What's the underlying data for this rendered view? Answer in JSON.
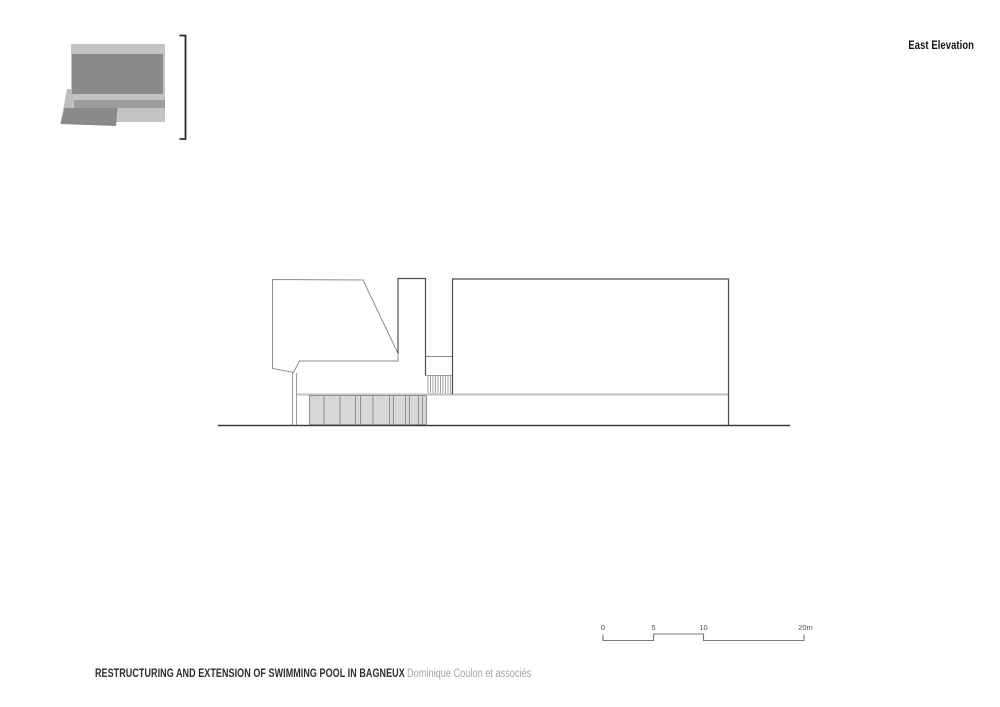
{
  "header": {
    "view_label": "East Elevation"
  },
  "footer": {
    "project_title": "RESTRUCTURING AND EXTENSION OF SWIMMING POOL IN BAGNEUX",
    "architect": "Dominique Coulon et associés"
  },
  "scale_bar": {
    "unit": "m",
    "ticks": [
      {
        "label": "0",
        "x": 603
      },
      {
        "label": "5",
        "x": 653.5
      },
      {
        "label": "10",
        "x": 703.5
      },
      {
        "label": "20m",
        "x": 805.5
      }
    ]
  },
  "colors": {
    "background": "#ffffff",
    "outline_dark": "#4e4e4e",
    "outline_soft": "#8c8c8c",
    "line_light": "#c7c7c7",
    "line_detail": "#9c9c9c",
    "panel_fill": "#d7d7d7",
    "ground": "#3c3c3c",
    "plan_light": "#c3c3c5",
    "plan_mid": "#9c9c9e",
    "plan_dark": "#8a8a8c",
    "text_primary": "#141414",
    "text_title": "#2e2e2e",
    "text_muted": "#a3a3a3",
    "text_scale": "#555555"
  },
  "key_plan": {
    "shapes": [
      {
        "type": "rect",
        "name": "site-light-block",
        "x": 71,
        "y": 44,
        "width": 94,
        "height": 78,
        "fill": "#c3c3c5"
      },
      {
        "type": "polygon",
        "name": "site-light-slant",
        "points": "67,89 77,89 66,123.5 60.5,123.5",
        "fill": "#bdbdbf"
      },
      {
        "type": "rect",
        "name": "site-main-building",
        "x": 72,
        "y": 54,
        "width": 91,
        "height": 40,
        "fill": "#8a8a8c"
      },
      {
        "type": "rect",
        "name": "site-mid-strip",
        "x": 74,
        "y": 100,
        "width": 91,
        "height": 8,
        "fill": "#9c9c9e"
      },
      {
        "type": "polygon",
        "name": "site-dark-wing",
        "points": "64.5,108 117.5,108 116,126 60.5,124",
        "fill": "#8a8a8c"
      },
      {
        "type": "polyline",
        "name": "section-bracket",
        "points": "179.5,35.5 185.5,35.5 185.5,139 179.5,139",
        "fill": "none",
        "stroke": "#2a2a2a",
        "stroke-width": 1.8
      }
    ]
  },
  "drawing": {
    "shapes": [
      {
        "type": "polygon",
        "name": "left-wing-outline",
        "points": "272.5,279.5 363,280 398,353.5 398,361 299.5,361 293.5,372.5 272.5,368.5",
        "fill": "#ffffff",
        "stroke": "#8c8c8c",
        "stroke-width": 1
      },
      {
        "type": "line",
        "name": "band-post-line",
        "x1": 292.5,
        "y1": 373,
        "x2": 292.5,
        "y2": 425,
        "stroke": "#9c9c9c",
        "stroke-width": 1
      },
      {
        "type": "line",
        "name": "band-post-line",
        "x1": 296.5,
        "y1": 373,
        "x2": 296.5,
        "y2": 425,
        "stroke": "#9c9c9c",
        "stroke-width": 1
      },
      {
        "type": "line",
        "name": "lower-level-line",
        "x1": 297,
        "y1": 394.5,
        "x2": 728.5,
        "y2": 394.5,
        "stroke": "#c7c7c7",
        "stroke-width": 2.2
      },
      {
        "type": "rect",
        "name": "pilotis-panels",
        "x": 309.5,
        "y": 395.5,
        "width": 117,
        "height": 29.3,
        "fill": "#d7d7d7",
        "stroke": "#8f8f8f",
        "stroke-width": 1
      },
      {
        "type": "line",
        "name": "panel-divider",
        "x1": 324,
        "y1": 395.5,
        "x2": 324,
        "y2": 424.8,
        "stroke": "#8f8f8f",
        "stroke-width": 1
      },
      {
        "type": "line",
        "name": "panel-divider",
        "x1": 340,
        "y1": 395.5,
        "x2": 340,
        "y2": 424.8,
        "stroke": "#8f8f8f",
        "stroke-width": 1
      },
      {
        "type": "line",
        "name": "panel-divider",
        "x1": 355.5,
        "y1": 395.5,
        "x2": 355.5,
        "y2": 424.8,
        "stroke": "#8f8f8f",
        "stroke-width": 1
      },
      {
        "type": "line",
        "name": "panel-divider",
        "x1": 360.5,
        "y1": 395.5,
        "x2": 360.5,
        "y2": 424.8,
        "stroke": "#8f8f8f",
        "stroke-width": 1
      },
      {
        "type": "line",
        "name": "panel-divider",
        "x1": 373,
        "y1": 395.5,
        "x2": 373,
        "y2": 424.8,
        "stroke": "#8f8f8f",
        "stroke-width": 1
      },
      {
        "type": "line",
        "name": "panel-divider",
        "x1": 389.5,
        "y1": 395.5,
        "x2": 389.5,
        "y2": 424.8,
        "stroke": "#8f8f8f",
        "stroke-width": 1
      },
      {
        "type": "line",
        "name": "panel-divider",
        "x1": 393.5,
        "y1": 395.5,
        "x2": 393.5,
        "y2": 424.8,
        "stroke": "#8f8f8f",
        "stroke-width": 1
      },
      {
        "type": "line",
        "name": "panel-divider",
        "x1": 405.5,
        "y1": 395.5,
        "x2": 405.5,
        "y2": 424.8,
        "stroke": "#8f8f8f",
        "stroke-width": 1
      },
      {
        "type": "line",
        "name": "panel-divider",
        "x1": 409.5,
        "y1": 395.5,
        "x2": 409.5,
        "y2": 424.8,
        "stroke": "#8f8f8f",
        "stroke-width": 1
      },
      {
        "type": "line",
        "name": "panel-divider",
        "x1": 418.5,
        "y1": 395.5,
        "x2": 418.5,
        "y2": 424.8,
        "stroke": "#8f8f8f",
        "stroke-width": 1
      },
      {
        "type": "line",
        "name": "panel-divider",
        "x1": 422.5,
        "y1": 395.5,
        "x2": 422.5,
        "y2": 424.8,
        "stroke": "#8f8f8f",
        "stroke-width": 1
      },
      {
        "type": "line",
        "name": "vent-hatch-line",
        "x1": 428,
        "y1": 375.5,
        "x2": 428,
        "y2": 393.5,
        "stroke": "#9c9c9c",
        "stroke-width": 0.9
      },
      {
        "type": "line",
        "name": "vent-hatch-line",
        "x1": 430.5,
        "y1": 375.5,
        "x2": 430.5,
        "y2": 393.5,
        "stroke": "#9c9c9c",
        "stroke-width": 0.9
      },
      {
        "type": "line",
        "name": "vent-hatch-line",
        "x1": 433,
        "y1": 375.5,
        "x2": 433,
        "y2": 393.5,
        "stroke": "#9c9c9c",
        "stroke-width": 0.9
      },
      {
        "type": "line",
        "name": "vent-hatch-line",
        "x1": 435.5,
        "y1": 375.5,
        "x2": 435.5,
        "y2": 393.5,
        "stroke": "#9c9c9c",
        "stroke-width": 0.9
      },
      {
        "type": "line",
        "name": "vent-hatch-line",
        "x1": 438,
        "y1": 375.5,
        "x2": 438,
        "y2": 393.5,
        "stroke": "#9c9c9c",
        "stroke-width": 0.9
      },
      {
        "type": "line",
        "name": "vent-hatch-line",
        "x1": 440.5,
        "y1": 375.5,
        "x2": 440.5,
        "y2": 393.5,
        "stroke": "#9c9c9c",
        "stroke-width": 0.9
      },
      {
        "type": "line",
        "name": "vent-hatch-line",
        "x1": 443,
        "y1": 375.5,
        "x2": 443,
        "y2": 393.5,
        "stroke": "#9c9c9c",
        "stroke-width": 0.9
      },
      {
        "type": "line",
        "name": "vent-hatch-line",
        "x1": 445.5,
        "y1": 375.5,
        "x2": 445.5,
        "y2": 393.5,
        "stroke": "#9c9c9c",
        "stroke-width": 0.9
      },
      {
        "type": "line",
        "name": "vent-hatch-line",
        "x1": 448,
        "y1": 375.5,
        "x2": 448,
        "y2": 393.5,
        "stroke": "#9c9c9c",
        "stroke-width": 0.9
      },
      {
        "type": "line",
        "name": "vent-hatch-line",
        "x1": 450.5,
        "y1": 375.5,
        "x2": 450.5,
        "y2": 393.5,
        "stroke": "#9c9c9c",
        "stroke-width": 0.9
      },
      {
        "type": "line",
        "name": "vent-hatch-top",
        "x1": 425.5,
        "y1": 375.5,
        "x2": 452.5,
        "y2": 375.5,
        "stroke": "#9c9c9c",
        "stroke-width": 1
      },
      {
        "type": "line",
        "name": "gap-lintel-line",
        "x1": 425.5,
        "y1": 356.5,
        "x2": 452.5,
        "y2": 356.5,
        "stroke": "#8c8c8c",
        "stroke-width": 1
      },
      {
        "type": "polyline",
        "name": "tower-outline",
        "points": "398,353.5 398,278.5 425.5,278.5 425.5,375.5",
        "fill": "none",
        "stroke": "#4e4e4e",
        "stroke-width": 1.2
      },
      {
        "type": "polyline",
        "name": "main-hall-outline",
        "points": "452.5,394.5 452.5,279 728.5,279 728.5,425.5",
        "fill": "none",
        "stroke": "#4e4e4e",
        "stroke-width": 1.2
      },
      {
        "type": "line",
        "name": "ground-line",
        "x1": 218,
        "y1": 425.5,
        "x2": 790,
        "y2": 425.5,
        "stroke": "#3c3c3c",
        "stroke-width": 1.6
      },
      {
        "type": "polyline",
        "name": "scale-bar-line",
        "points": "603,634.5 603,640.5 653.5,640.5 653.5,634 703.5,634 703.5,640.5 804,640.5 804,634.5",
        "fill": "none",
        "stroke": "#7a7a7a",
        "stroke-width": 1.1
      }
    ]
  }
}
